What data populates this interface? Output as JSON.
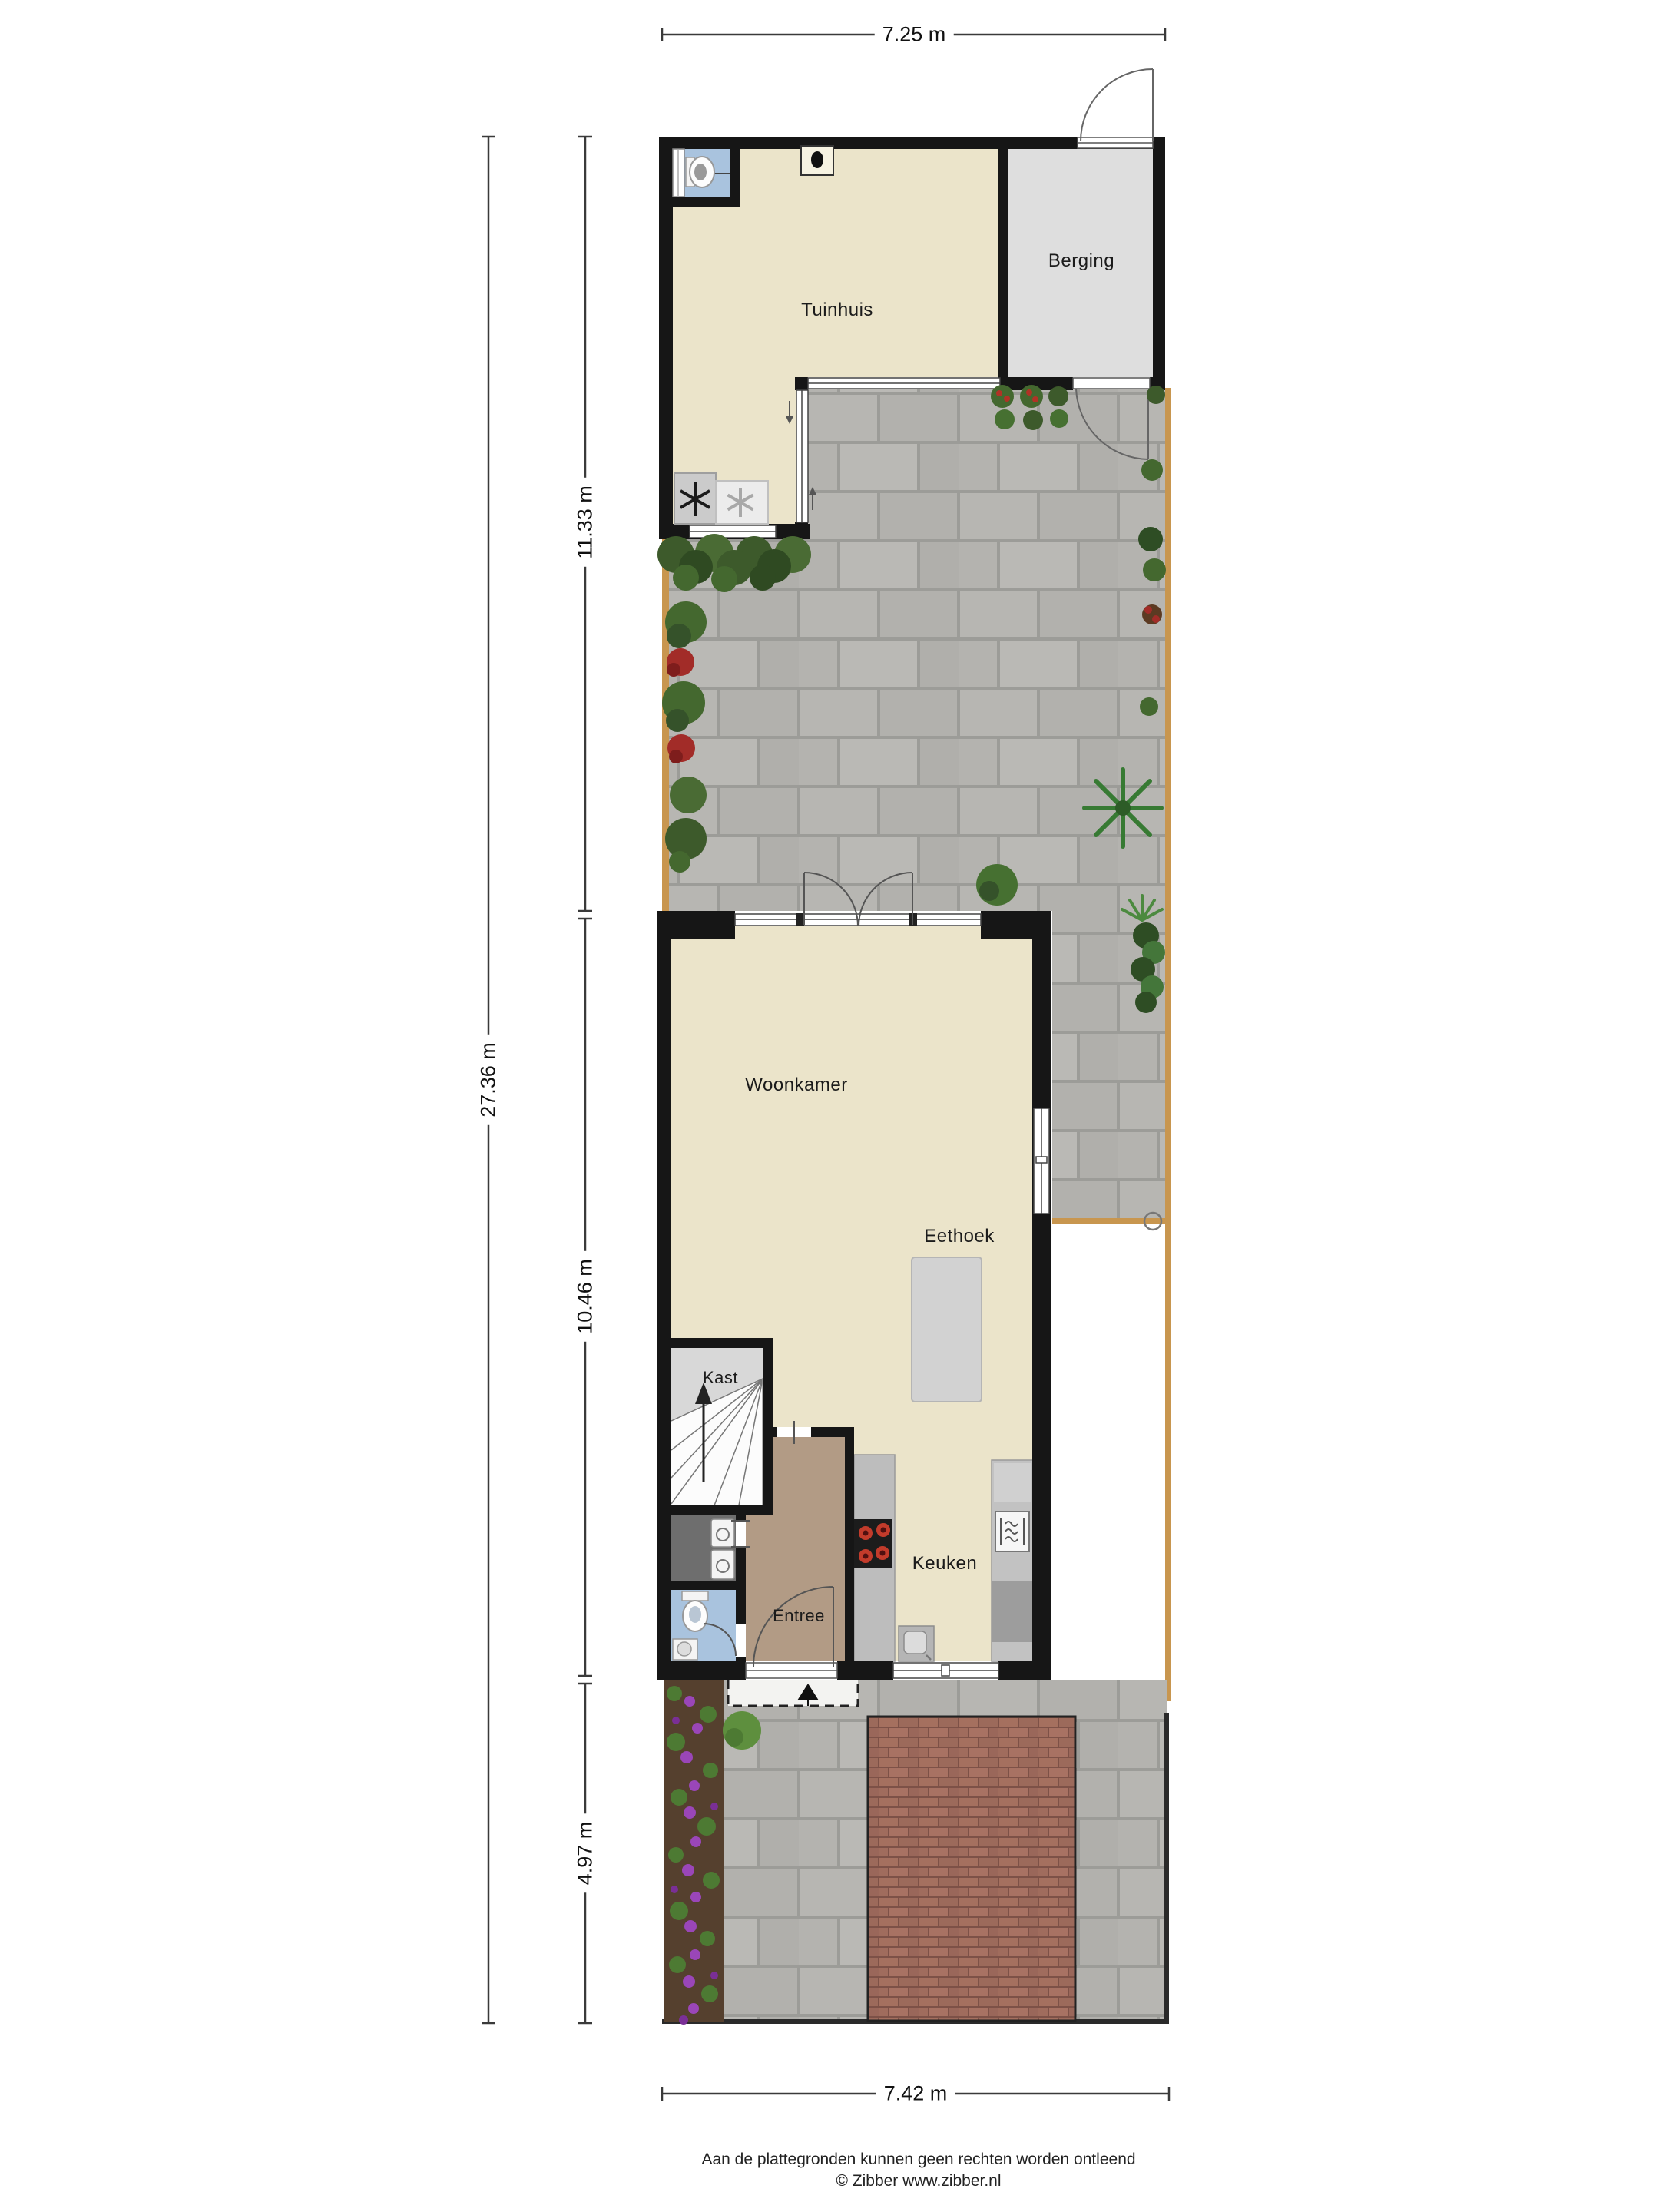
{
  "plan": {
    "rooms": {
      "tuinhuis": "Tuinhuis",
      "berging": "Berging",
      "woonkamer": "Woonkamer",
      "eethoek": "Eethoek",
      "kast": "Kast",
      "entree": "Entree",
      "keuken": "Keuken"
    },
    "dimensions": {
      "width_back": "7.25 m",
      "total_depth": "27.36 m",
      "back_depth": "11.33 m",
      "house_depth": "10.46 m",
      "front_depth": "4.97 m",
      "width_front": "7.42 m"
    },
    "footer": {
      "disclaimer": "Aan de plattegronden kunnen geen rechten worden ontleend",
      "credit": "© Zibber www.zibber.nl"
    },
    "colors": {
      "wall": "#161616",
      "room_floor": "#ebe4ca",
      "storage_floor": "#dedede",
      "entree_floor": "#b29b85",
      "toilet_floor": "#a9c3de",
      "utility_floor": "#6e6e6e",
      "paving_tile": "#b7b6b2",
      "brick_driveway": "#a5705f",
      "fence_wood": "#c8964f",
      "hob_burner": "#c23b2b"
    }
  }
}
